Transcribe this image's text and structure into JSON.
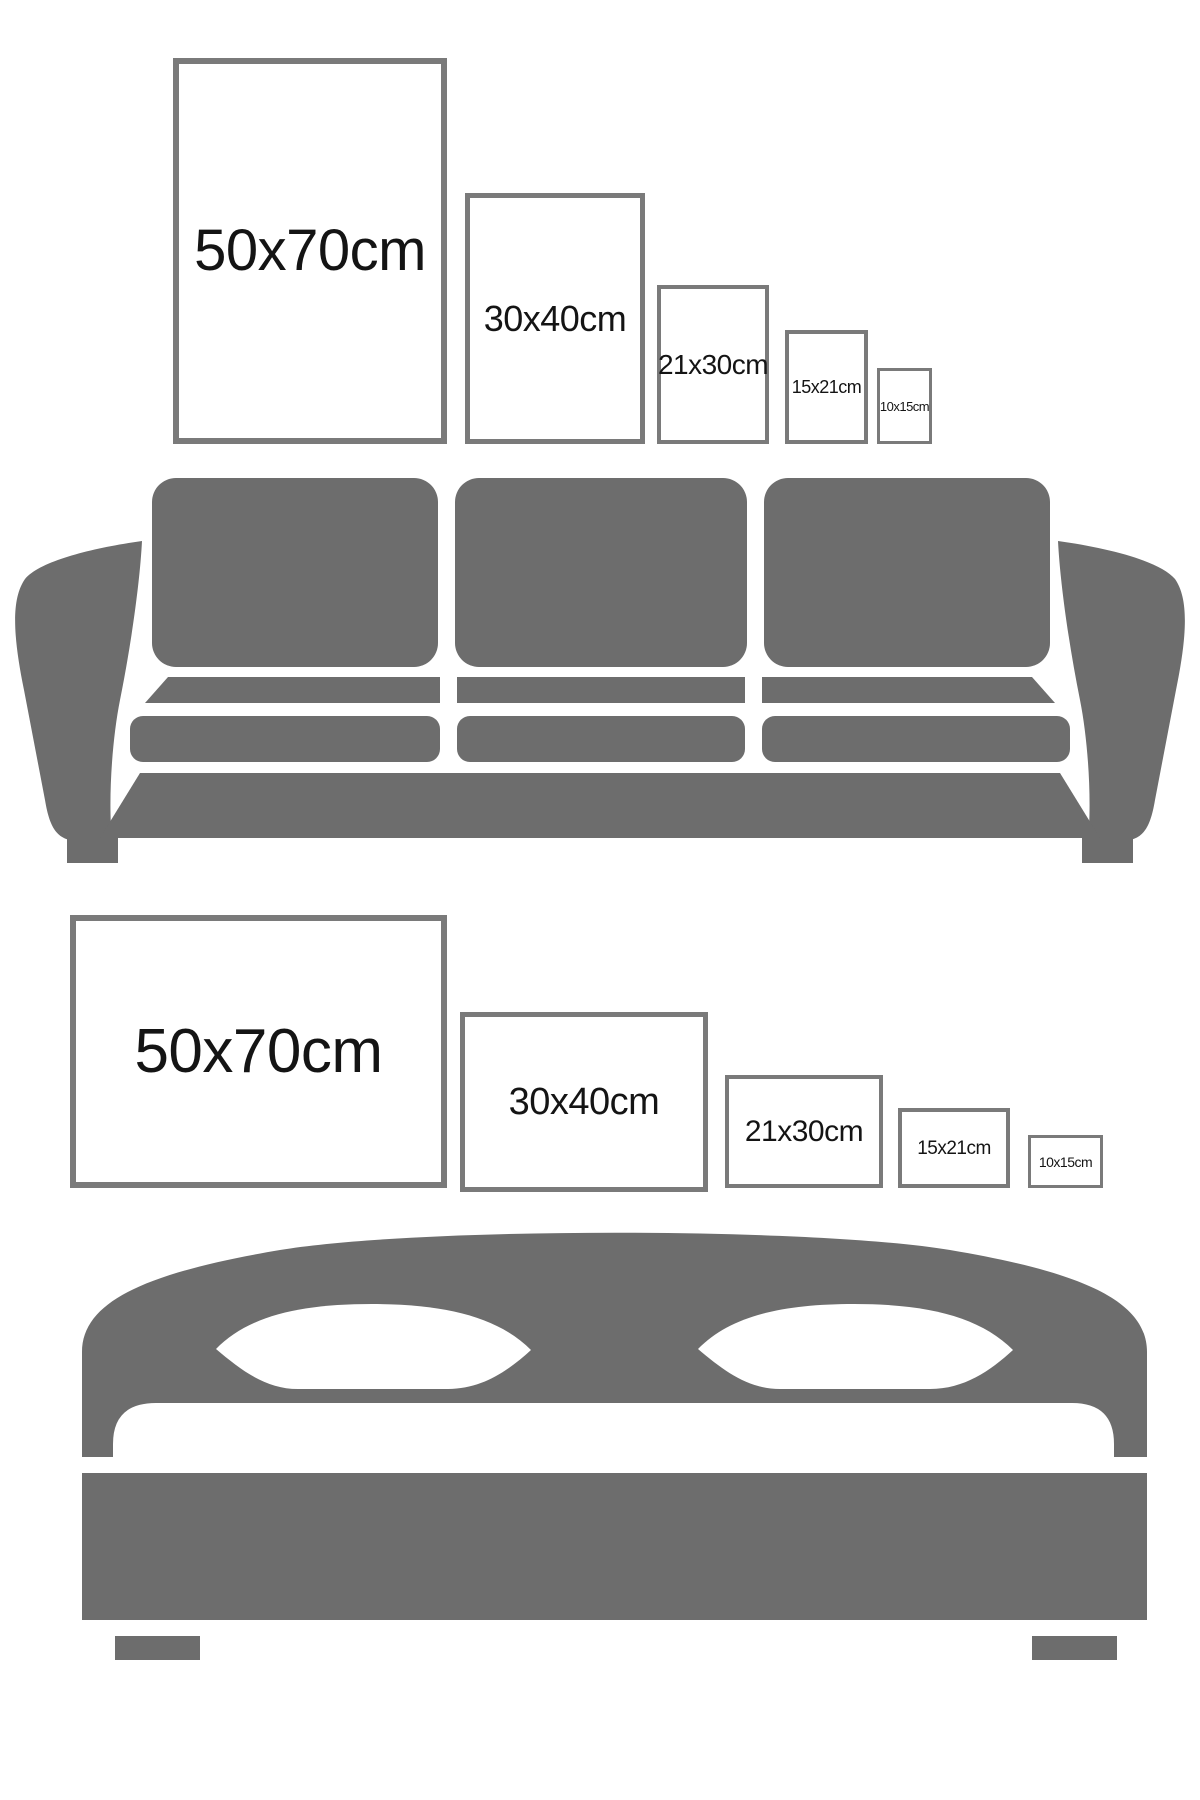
{
  "page": {
    "description": "Poster frame size comparison guide shown at scale above a sofa and a bed"
  },
  "colors": {
    "background": "#ffffff",
    "furniture_gray": "#6d6d6d",
    "frame_border_gray": "#7a7a7a",
    "label_text": "#141414"
  },
  "sofa_section": {
    "furniture_name": "sofa",
    "frames": [
      {
        "label": "50x70cm",
        "orientation": "portrait",
        "width_cm": 50,
        "height_cm": 70
      },
      {
        "label": "30x40cm",
        "orientation": "portrait",
        "width_cm": 30,
        "height_cm": 40
      },
      {
        "label": "21x30cm",
        "orientation": "portrait",
        "width_cm": 21,
        "height_cm": 30
      },
      {
        "label": "15x21cm",
        "orientation": "portrait",
        "width_cm": 15,
        "height_cm": 21
      },
      {
        "label": "10x15cm",
        "orientation": "portrait",
        "width_cm": 10,
        "height_cm": 15
      }
    ]
  },
  "bed_section": {
    "furniture_name": "bed",
    "frames": [
      {
        "label": "50x70cm",
        "orientation": "landscape",
        "width_cm": 70,
        "height_cm": 50
      },
      {
        "label": "30x40cm",
        "orientation": "landscape",
        "width_cm": 40,
        "height_cm": 30
      },
      {
        "label": "21x30cm",
        "orientation": "landscape",
        "width_cm": 30,
        "height_cm": 21
      },
      {
        "label": "15x21cm",
        "orientation": "landscape",
        "width_cm": 21,
        "height_cm": 15
      },
      {
        "label": "10x15cm",
        "orientation": "landscape",
        "width_cm": 15,
        "height_cm": 10
      }
    ]
  }
}
